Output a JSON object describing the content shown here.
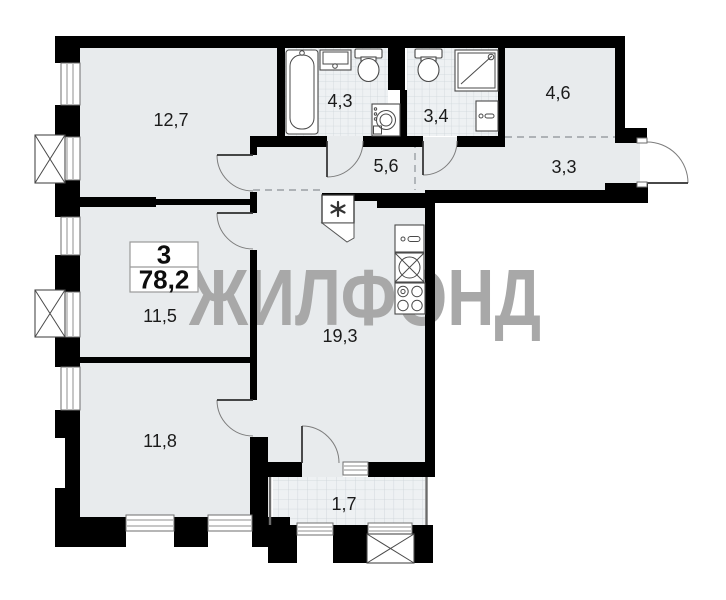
{
  "watermark_text": "ЖИЛФОНД",
  "summary_box": {
    "rooms_count": "3",
    "total_area_m2": "78,2"
  },
  "room_areas": {
    "living_room": "12,7",
    "bathroom": "4,3",
    "toilet": "3,4",
    "wardrobe": "4,6",
    "hallway": "5,6",
    "entry_hall": "3,3",
    "bedroom": "11,5",
    "kitchen_living": "19,3",
    "bedroom2": "11,8",
    "balcony": "1,7"
  },
  "colors": {
    "wall": "#000000",
    "floor": "#e8ebed",
    "tile_floor": "#eef1f3",
    "tile_line": "#cfd6da",
    "fixture_outline": "#4a4a4a",
    "watermark": "#a8a8a8"
  },
  "fixtures": [
    "bathtub-icon",
    "sink-icon",
    "toilet-icon",
    "washing-machine-icon",
    "toilet-icon",
    "shower-icon",
    "vanity-icon",
    "vent-shaft-icon",
    "kitchen-cabinet-icon",
    "kitchen-sink-icon",
    "stove-icon",
    "ac-unit-icon",
    "ac-unit-icon",
    "ac-unit-icon"
  ]
}
